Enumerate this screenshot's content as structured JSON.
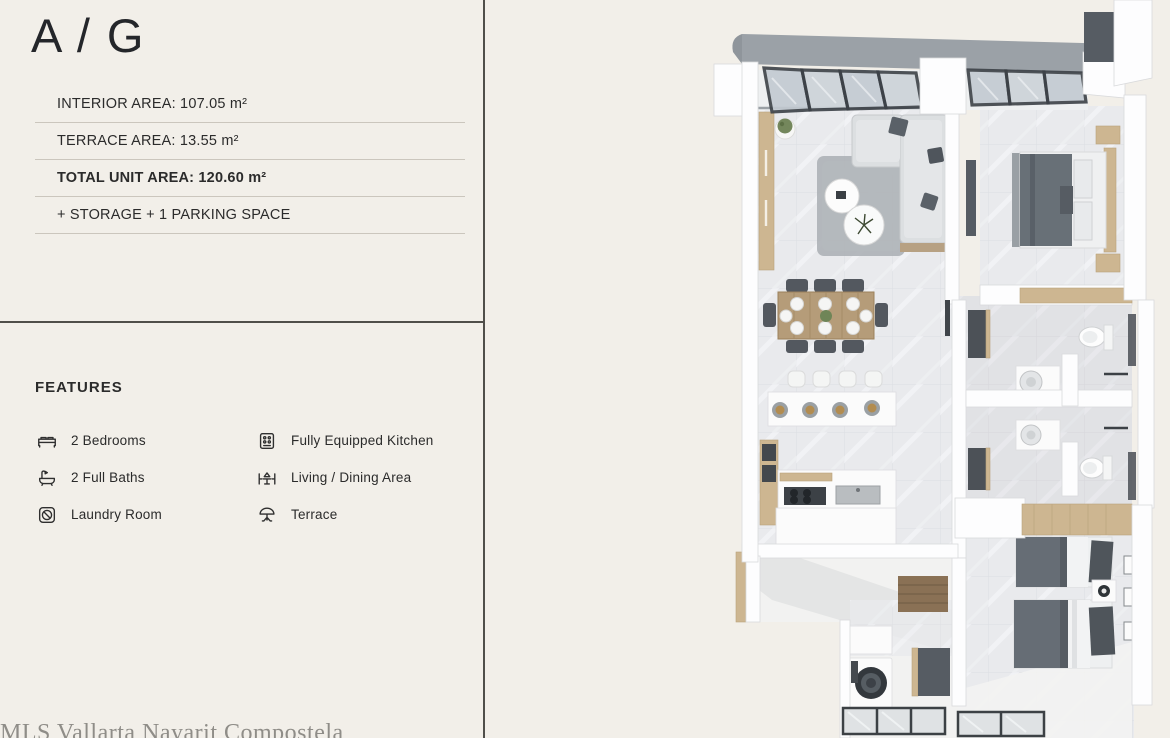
{
  "page": {
    "eyebrow": "APARTMENT",
    "unit_name": "A / G",
    "watermark": "MLS Vallarta Nayarit Compostela"
  },
  "specs": {
    "rows": [
      {
        "text": "INTERIOR AREA: 107.05 m²"
      },
      {
        "text": "TERRACE AREA: 13.55 m²"
      },
      {
        "text": "TOTAL UNIT AREA: 120.60 m²"
      },
      {
        "text": "+ STORAGE + 1 PARKING SPACE"
      }
    ]
  },
  "features": {
    "heading": "FEATURES",
    "items": [
      {
        "icon": "bed-icon",
        "label": "2 Bedrooms"
      },
      {
        "icon": "bathtub-icon",
        "label": "2 Full Baths"
      },
      {
        "icon": "washing-machine-icon",
        "label": "Laundry Room"
      },
      {
        "icon": "stove-icon",
        "label": "Fully Equipped Kitchen"
      },
      {
        "icon": "dining-table-icon",
        "label": "Living / Dining Area"
      },
      {
        "icon": "parasol-icon",
        "label": "Terrace"
      }
    ]
  },
  "colors": {
    "background": "#f2efe9",
    "text": "#2b2b2b",
    "divider": "#504f4a",
    "rule": "#cbc6bd",
    "watermark": "#8f8d88",
    "wall_white": "#fdfdfe",
    "floor_marble": "#e9eaed",
    "wood_accent": "#cdb691",
    "dark_fixture": "#565c63",
    "pergola_frame": "#3c4147",
    "roof_gray": "#9ba1a7"
  }
}
